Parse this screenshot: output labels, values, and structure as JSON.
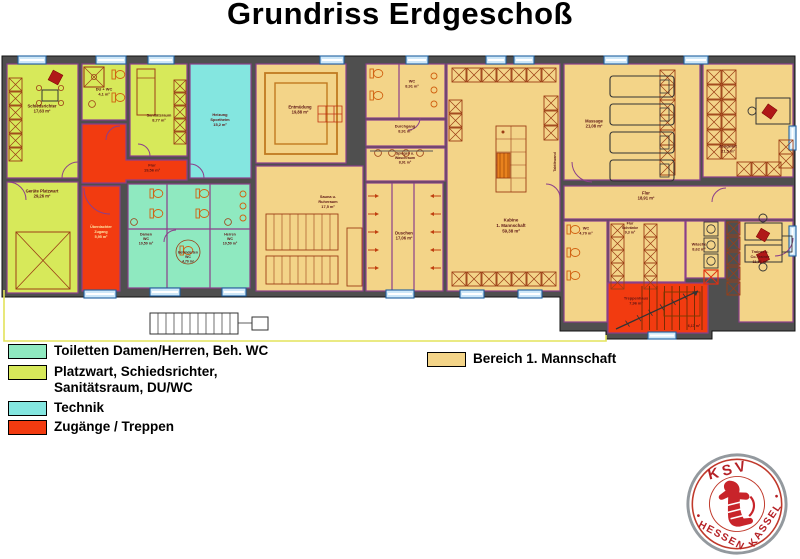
{
  "title": "Grundriss Erdgeschoß",
  "colors": {
    "wall": "#4f4f4f",
    "room_border": "#8b3f8b",
    "label": "#5c1414",
    "toilets": "#8fe9c0",
    "platzwart": "#d7e95a",
    "technik": "#84e6e0",
    "zugang": "#f23b10",
    "mannschaft": "#f3d488",
    "window": "#cfe8f8",
    "logo_red": "#b52025"
  },
  "rooms": {
    "schiedsrichter": {
      "lines": [
        "Schiedsrichter",
        "17,63 m²"
      ]
    },
    "du_wc": {
      "lines": [
        "DU + WC",
        "4,1 m²"
      ]
    },
    "sanitaetsraum": {
      "lines": [
        "Sanitätsraum",
        "8,77 m²"
      ]
    },
    "heizung": {
      "lines": [
        "Heizung",
        "Sportheim",
        "15,2 m²"
      ]
    },
    "geraete_platzwart": {
      "lines": [
        "Geräte Platzwart",
        "29,26 m²"
      ]
    },
    "flur_eg": {
      "lines": [
        "Flur",
        "19,56 m²"
      ]
    },
    "ueberdachter_zugang": {
      "lines": [
        "Überdachter",
        "Zugang",
        "5,95 m²"
      ]
    },
    "damen_wc": {
      "lines": [
        "Damen",
        "WC",
        "10,50 m²"
      ]
    },
    "beh_wc": {
      "lines": [
        "Behinderten",
        "WC",
        "4,70 m²"
      ]
    },
    "herren_wc": {
      "lines": [
        "Herren",
        "WC",
        "10,50 m²"
      ]
    },
    "entmuedung": {
      "lines": [
        "Entmüdung",
        "19,88 m²"
      ]
    },
    "sauna": {
      "lines": [
        "Sauna u.",
        "Ruheraum",
        "17,5 m²"
      ]
    },
    "wc_mitte": {
      "lines": [
        "WC",
        "8,91 m²"
      ]
    },
    "durchgang": {
      "lines": [
        "Durchgang",
        "8,91 m²"
      ]
    },
    "spiegel": {
      "lines": [
        "Spiegel- u.",
        "Waschraum",
        "8,91 m²"
      ]
    },
    "duschen": {
      "lines": [
        "Duschen",
        "17,06 m²"
      ]
    },
    "kabine": {
      "lines": [
        "Kabine",
        "1. Mannschaft",
        "59,38 m²"
      ]
    },
    "massage": {
      "lines": [
        "Massage",
        "21,08 m²"
      ]
    },
    "zeugwart": {
      "lines": [
        "Zeugwart",
        "21,5 m²"
      ]
    },
    "flur_right": {
      "lines": [
        "Flur",
        "18,91 m²"
      ]
    },
    "wc_right": {
      "lines": [
        "WC",
        "4,70 m²"
      ]
    },
    "flur_schraenke": {
      "lines": [
        "Flur",
        "Schränke",
        "9,3 m²"
      ]
    },
    "waesche": {
      "lines": [
        "Wäsche",
        "8,62 m²"
      ]
    },
    "trainer": {
      "lines": [
        "Trainer u.",
        "Co-Trainer",
        "11,56 m²"
      ]
    },
    "treppenhaus": {
      "lines": [
        "Treppenhaus",
        "7,96 m²"
      ]
    },
    "treppe_area": {
      "lines": [
        "6,17 m²"
      ]
    },
    "taktikwand": {
      "lines": [
        "Taktikwand"
      ]
    }
  },
  "legend": {
    "items": [
      {
        "color": "toilets",
        "label": "Toiletten Damen/Herren, Beh. WC",
        "label2": ""
      },
      {
        "color": "platzwart",
        "label": "Platzwart, Schiedsrichter,",
        "label2": "Sanitätsraum, DU/WC"
      },
      {
        "color": "technik",
        "label": "Technik",
        "label2": ""
      },
      {
        "color": "zugang",
        "label": "Zugänge / Treppen",
        "label2": ""
      }
    ],
    "bereich": {
      "color": "mannschaft",
      "label": "Bereich 1. Mannschaft"
    }
  },
  "logo": {
    "top": "KSV",
    "left": "HESSEN",
    "right": "KASSEL"
  }
}
